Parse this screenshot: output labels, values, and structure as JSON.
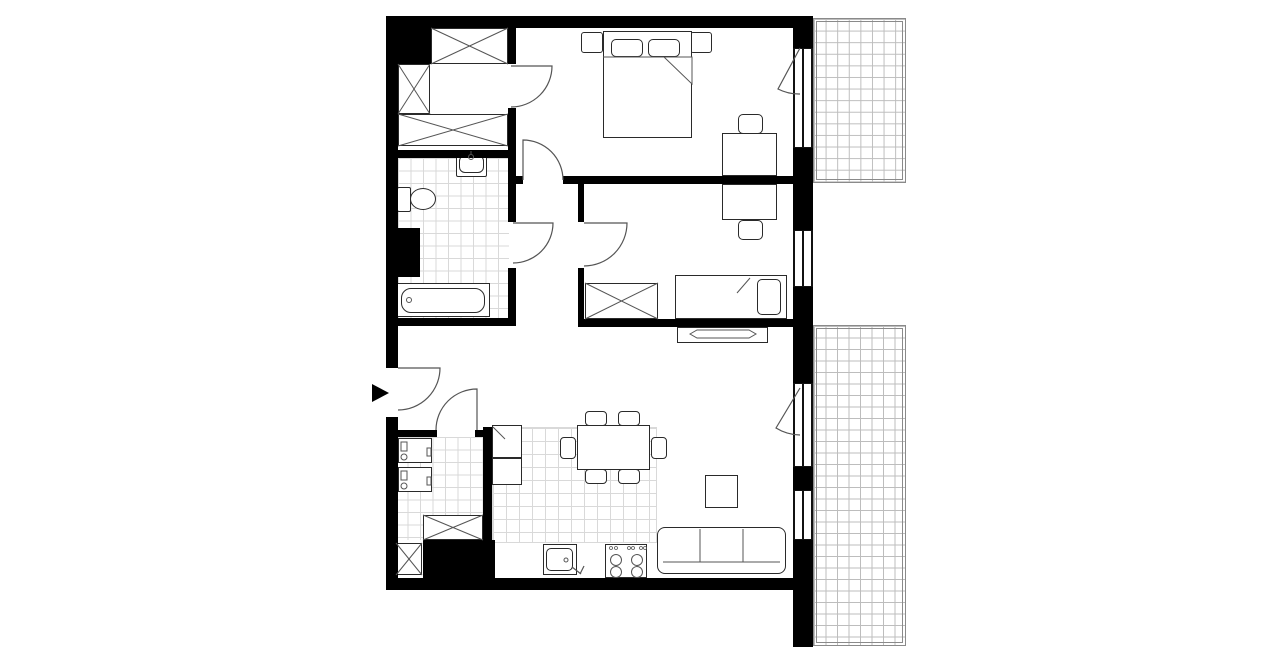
{
  "canvas": {
    "w": 1280,
    "h": 667,
    "bg": "#ffffff"
  },
  "colors": {
    "wall": "#000000",
    "line": "#2a2a2a",
    "thin": "#555555",
    "tile": "#d9d9d9",
    "balconyLine": "#bdbdbd",
    "frame": "#8a8a8a"
  },
  "tiles": [
    {
      "name": "bathroom-floor-tiles",
      "x": 398,
      "y": 158,
      "w": 111,
      "h": 160,
      "cell": 12.5
    },
    {
      "name": "utility-floor-tiles",
      "x": 395,
      "y": 437,
      "w": 88,
      "h": 103,
      "cell": 12.5
    },
    {
      "name": "kitchen-floor-tiles",
      "x": 492,
      "y": 427,
      "w": 165,
      "h": 116,
      "cell": 13,
      "edge": true
    },
    {
      "name": "balcony-top-floor",
      "x": 813,
      "y": 18,
      "w": 93,
      "h": 165,
      "cell": 11.6,
      "frame": true
    },
    {
      "name": "terrace-bottom-floor",
      "x": 813,
      "y": 325,
      "w": 93,
      "h": 321,
      "cell": 11.5,
      "frame": true
    }
  ],
  "furniture": [
    {
      "name": "bedroom1-nightstand-left",
      "x": 581,
      "y": 32,
      "w": 22,
      "h": 21,
      "r": 3
    },
    {
      "name": "bedroom1-nightstand-right",
      "x": 690,
      "y": 32,
      "w": 22,
      "h": 21,
      "r": 3
    },
    {
      "name": "bedroom1-double-bed",
      "x": 603,
      "y": 31,
      "w": 89,
      "h": 107
    },
    {
      "name": "bedroom1-pillow-left",
      "x": 611,
      "y": 39,
      "w": 32,
      "h": 18,
      "r": 5
    },
    {
      "name": "bedroom1-pillow-right",
      "x": 648,
      "y": 39,
      "w": 32,
      "h": 18,
      "r": 5
    },
    {
      "name": "bedroom1-desk",
      "x": 722,
      "y": 133,
      "w": 55,
      "h": 43
    },
    {
      "name": "bedroom1-desk-chair",
      "x": 738,
      "y": 114,
      "w": 25,
      "h": 20,
      "r": 5
    },
    {
      "name": "dressing-wardrobe-top",
      "x": 431,
      "y": 28,
      "w": 77,
      "h": 36
    },
    {
      "name": "dressing-wardrobe-left",
      "x": 398,
      "y": 64,
      "w": 32,
      "h": 50
    },
    {
      "name": "dressing-wardrobe-bottom",
      "x": 398,
      "y": 114,
      "w": 110,
      "h": 32
    },
    {
      "name": "bedroom2-desk",
      "x": 722,
      "y": 184,
      "w": 55,
      "h": 36
    },
    {
      "name": "bedroom2-desk-chair",
      "x": 738,
      "y": 220,
      "w": 25,
      "h": 20,
      "r": 5
    },
    {
      "name": "bedroom2-wardrobe",
      "x": 585,
      "y": 283,
      "w": 73,
      "h": 36
    },
    {
      "name": "bedroom2-single-bed",
      "x": 675,
      "y": 275,
      "w": 112,
      "h": 44
    },
    {
      "name": "bedroom2-pillow",
      "x": 757,
      "y": 279,
      "w": 24,
      "h": 36,
      "r": 5
    },
    {
      "name": "tv-sideboard",
      "x": 677,
      "y": 327,
      "w": 91,
      "h": 16
    },
    {
      "name": "coffee-table",
      "x": 705,
      "y": 475,
      "w": 33,
      "h": 33
    },
    {
      "name": "sofa",
      "x": 657,
      "y": 527,
      "w": 129,
      "h": 47,
      "r": 8
    },
    {
      "name": "fridge-unit",
      "x": 492,
      "y": 425,
      "w": 30,
      "h": 33
    },
    {
      "name": "kitchen-unit",
      "x": 492,
      "y": 458,
      "w": 30,
      "h": 27
    },
    {
      "name": "dining-table",
      "x": 577,
      "y": 425,
      "w": 73,
      "h": 45
    },
    {
      "name": "dining-chair-north-1",
      "x": 585,
      "y": 411,
      "w": 22,
      "h": 15,
      "r": 4
    },
    {
      "name": "dining-chair-north-2",
      "x": 618,
      "y": 411,
      "w": 22,
      "h": 15,
      "r": 4
    },
    {
      "name": "dining-chair-south-1",
      "x": 585,
      "y": 469,
      "w": 22,
      "h": 15,
      "r": 4
    },
    {
      "name": "dining-chair-south-2",
      "x": 618,
      "y": 469,
      "w": 22,
      "h": 15,
      "r": 4
    },
    {
      "name": "dining-chair-west",
      "x": 560,
      "y": 437,
      "w": 16,
      "h": 22,
      "r": 4
    },
    {
      "name": "dining-chair-east",
      "x": 651,
      "y": 437,
      "w": 16,
      "h": 22,
      "r": 4
    },
    {
      "name": "kitchen-sink-unit",
      "x": 543,
      "y": 544,
      "w": 34,
      "h": 31
    },
    {
      "name": "kitchen-sink-basin",
      "x": 546,
      "y": 548,
      "w": 27,
      "h": 23,
      "r": 5,
      "bw": 1
    },
    {
      "name": "stove",
      "x": 605,
      "y": 544,
      "w": 42,
      "h": 34
    },
    {
      "name": "washing-machine-1",
      "x": 398,
      "y": 438,
      "w": 34,
      "h": 25
    },
    {
      "name": "washing-machine-2",
      "x": 398,
      "y": 467,
      "w": 34,
      "h": 25
    },
    {
      "name": "utility-wardrobe-1",
      "x": 423,
      "y": 515,
      "w": 60,
      "h": 25
    },
    {
      "name": "utility-wardrobe-2",
      "x": 396,
      "y": 543,
      "w": 26,
      "h": 32
    },
    {
      "name": "bathroom-sink",
      "x": 456,
      "y": 151,
      "w": 31,
      "h": 26,
      "r": 2
    },
    {
      "name": "bathroom-sink-basin",
      "x": 459,
      "y": 155,
      "w": 25,
      "h": 18,
      "r": 6,
      "bw": 1
    },
    {
      "name": "toilet-tank",
      "x": 397,
      "y": 187,
      "w": 14,
      "h": 25,
      "r": 2
    },
    {
      "name": "toilet-bowl",
      "x": 410,
      "y": 188,
      "w": 26,
      "h": 22,
      "r": "50%"
    },
    {
      "name": "bathtub",
      "x": 396,
      "y": 283,
      "w": 94,
      "h": 34
    },
    {
      "name": "bathtub-inner",
      "x": 401,
      "y": 288,
      "w": 84,
      "h": 25,
      "r": 10,
      "bw": 1
    }
  ],
  "walls": [
    {
      "name": "wall-top",
      "x": 386,
      "y": 16,
      "w": 407,
      "h": 12
    },
    {
      "name": "wall-left-upper",
      "x": 386,
      "y": 16,
      "w": 12,
      "h": 352
    },
    {
      "name": "wall-left-lower",
      "x": 386,
      "y": 417,
      "w": 12,
      "h": 173
    },
    {
      "name": "wall-bottom",
      "x": 386,
      "y": 578,
      "w": 407,
      "h": 12
    },
    {
      "name": "corner-block",
      "x": 398,
      "y": 16,
      "w": 33,
      "h": 48
    },
    {
      "name": "dressing-east-wall-upper",
      "x": 508,
      "y": 28,
      "w": 8,
      "h": 36
    },
    {
      "name": "dressing-east-wall-lower",
      "x": 508,
      "y": 108,
      "w": 8,
      "h": 50
    },
    {
      "name": "bathroom-north-wall",
      "x": 386,
      "y": 150,
      "w": 130,
      "h": 8
    },
    {
      "name": "bathroom-east-wall-upper",
      "x": 508,
      "y": 158,
      "w": 8,
      "h": 64
    },
    {
      "name": "bathroom-east-wall-lower",
      "x": 508,
      "y": 268,
      "w": 8,
      "h": 58
    },
    {
      "name": "bathroom-south-wall",
      "x": 386,
      "y": 318,
      "w": 130,
      "h": 8
    },
    {
      "name": "bathroom-shaft",
      "x": 386,
      "y": 228,
      "w": 34,
      "h": 49
    },
    {
      "name": "bedroom1-south-wall-nub",
      "x": 516,
      "y": 176,
      "w": 7,
      "h": 8
    },
    {
      "name": "bedroom1-south-wall",
      "x": 563,
      "y": 176,
      "w": 230,
      "h": 8
    },
    {
      "name": "bedroom2-west-wall-upper",
      "x": 578,
      "y": 184,
      "w": 6,
      "h": 38
    },
    {
      "name": "bedroom2-west-wall-lower",
      "x": 578,
      "y": 268,
      "w": 6,
      "h": 59
    },
    {
      "name": "bedroom2-south-wall",
      "x": 578,
      "y": 319,
      "w": 215,
      "h": 8
    },
    {
      "name": "east-wall-top",
      "x": 793,
      "y": 16,
      "w": 20,
      "h": 32
    },
    {
      "name": "east-wall-mid-1",
      "x": 793,
      "y": 148,
      "w": 20,
      "h": 82
    },
    {
      "name": "east-wall-mid-2",
      "x": 793,
      "y": 287,
      "w": 20,
      "h": 96
    },
    {
      "name": "east-wall-mid-3",
      "x": 793,
      "y": 467,
      "w": 20,
      "h": 23
    },
    {
      "name": "east-wall-bottom",
      "x": 793,
      "y": 540,
      "w": 20,
      "h": 107
    },
    {
      "name": "utility-north-wall",
      "x": 395,
      "y": 430,
      "w": 42,
      "h": 7
    },
    {
      "name": "utility-north-stub",
      "x": 475,
      "y": 430,
      "w": 10,
      "h": 7
    },
    {
      "name": "kitchen-west-wall",
      "x": 483,
      "y": 427,
      "w": 9,
      "h": 160
    },
    {
      "name": "utility-shaft",
      "x": 423,
      "y": 540,
      "w": 72,
      "h": 38
    }
  ],
  "windows": [
    {
      "name": "bedroom1-balcony-window",
      "x": 793,
      "y": 48,
      "w": 20,
      "h": 100
    },
    {
      "name": "bedroom2-window",
      "x": 793,
      "y": 230,
      "w": 20,
      "h": 57
    },
    {
      "name": "livingroom-terrace-window-1",
      "x": 793,
      "y": 383,
      "w": 20,
      "h": 84
    },
    {
      "name": "livingroom-terrace-window-2",
      "x": 793,
      "y": 490,
      "w": 20,
      "h": 50
    }
  ],
  "svg": [
    {
      "name": "entry-door-swing",
      "kind": "path",
      "d": "M398,368 L440,368 A42,42 0 0 1 398,410"
    },
    {
      "name": "utility-door-swing",
      "kind": "path",
      "d": "M477,430 L477,389 A41,41 0 0 0 436,430"
    },
    {
      "name": "dressing-door-swing",
      "kind": "path",
      "d": "M511,66 L552,66 A41,41 0 0 1 511,107"
    },
    {
      "name": "bathroom-door-swing",
      "kind": "path",
      "d": "M513,223 L553,223 A40,40 0 0 1 513,263"
    },
    {
      "name": "bedroom1-door-swing",
      "kind": "path",
      "d": "M523,180 L523,140 A40,40 0 0 1 563,180"
    },
    {
      "name": "bedroom2-door-swing",
      "kind": "path",
      "d": "M584,223 L627,223 A43,43 0 0 1 584,266"
    },
    {
      "name": "bedroom1-balcony-door-swing",
      "kind": "path",
      "d": "M800,48 L778,89 A46,46 0 0 0 800,94"
    },
    {
      "name": "livingroom-balcony-door-swing",
      "kind": "path",
      "d": "M800,388 L776,428 A47,47 0 0 0 800,435"
    },
    {
      "name": "dressing-wardrobe-top-cross-1",
      "kind": "line",
      "x1": 431,
      "y1": 28,
      "x2": 508,
      "y2": 64,
      "sw": 1
    },
    {
      "name": "dressing-wardrobe-top-cross-2",
      "kind": "line",
      "x1": 508,
      "y1": 28,
      "x2": 431,
      "y2": 64,
      "sw": 1
    },
    {
      "name": "dressing-wardrobe-left-cross-1",
      "kind": "line",
      "x1": 398,
      "y1": 64,
      "x2": 430,
      "y2": 114,
      "sw": 1
    },
    {
      "name": "dressing-wardrobe-left-cross-2",
      "kind": "line",
      "x1": 430,
      "y1": 64,
      "x2": 398,
      "y2": 114,
      "sw": 1
    },
    {
      "name": "dressing-wardrobe-bottom-cross-1",
      "kind": "line",
      "x1": 398,
      "y1": 114,
      "x2": 508,
      "y2": 146,
      "sw": 1
    },
    {
      "name": "dressing-wardrobe-bottom-cross-2",
      "kind": "line",
      "x1": 508,
      "y1": 114,
      "x2": 398,
      "y2": 146,
      "sw": 1
    },
    {
      "name": "bedroom2-wardrobe-cross-1",
      "kind": "line",
      "x1": 585,
      "y1": 283,
      "x2": 658,
      "y2": 319,
      "sw": 1
    },
    {
      "name": "bedroom2-wardrobe-cross-2",
      "kind": "line",
      "x1": 658,
      "y1": 283,
      "x2": 585,
      "y2": 319,
      "sw": 1
    },
    {
      "name": "utility-wardrobe-1-cross-1",
      "kind": "line",
      "x1": 423,
      "y1": 515,
      "x2": 483,
      "y2": 540,
      "sw": 1
    },
    {
      "name": "utility-wardrobe-1-cross-2",
      "kind": "line",
      "x1": 483,
      "y1": 515,
      "x2": 423,
      "y2": 540,
      "sw": 1
    },
    {
      "name": "utility-wardrobe-2-cross-1",
      "kind": "line",
      "x1": 396,
      "y1": 543,
      "x2": 422,
      "y2": 575,
      "sw": 1
    },
    {
      "name": "utility-wardrobe-2-cross-2",
      "kind": "line",
      "x1": 422,
      "y1": 543,
      "x2": 396,
      "y2": 575,
      "sw": 1
    },
    {
      "name": "duvet-edge-line",
      "kind": "line",
      "x1": 603,
      "y1": 57,
      "x2": 692,
      "y2": 57,
      "sw": 1
    },
    {
      "name": "duvet-fold",
      "kind": "path",
      "d": "M664,57 L692,57 L692,84 Z",
      "fill": "#ffffff",
      "sw": 1
    },
    {
      "name": "bedroom2-blanket-fold",
      "kind": "line",
      "x1": 750,
      "y1": 278,
      "x2": 737,
      "y2": 293,
      "sw": 1
    },
    {
      "name": "tv-on-sideboard",
      "kind": "path",
      "d": "M690,334 L697,330 L749,330 L756,334 L749,338 L697,338 Z",
      "fill": "#ffffff",
      "sw": 1
    },
    {
      "name": "sofa-cushion-divider-1",
      "kind": "line",
      "x1": 700,
      "y1": 529,
      "x2": 700,
      "y2": 562,
      "sw": 1
    },
    {
      "name": "sofa-cushion-divider-2",
      "kind": "line",
      "x1": 743,
      "y1": 529,
      "x2": 743,
      "y2": 562,
      "sw": 1
    },
    {
      "name": "sofa-back-line",
      "kind": "line",
      "x1": 663,
      "y1": 562,
      "x2": 780,
      "y2": 562,
      "sw": 1
    },
    {
      "name": "fridge-door-diagonal",
      "kind": "line",
      "x1": 493,
      "y1": 427,
      "x2": 505,
      "y2": 439,
      "sw": 1
    },
    {
      "name": "kitchen-sink-drain",
      "kind": "circle",
      "cx": 566,
      "cy": 560,
      "r": 2,
      "sw": 1
    },
    {
      "name": "kitchen-sink-faucet",
      "kind": "path",
      "d": "M572,567 l9,7 M580,574 l4,-8",
      "sw": 1.2
    },
    {
      "name": "stove-knob-1",
      "kind": "circle",
      "cx": 611,
      "cy": 548,
      "r": 1.5,
      "sw": 0.8
    },
    {
      "name": "stove-knob-2",
      "kind": "circle",
      "cx": 616,
      "cy": 548,
      "r": 1.5,
      "sw": 0.8
    },
    {
      "name": "stove-knob-3",
      "kind": "circle",
      "cx": 629,
      "cy": 548,
      "r": 1.5,
      "sw": 0.8
    },
    {
      "name": "stove-knob-4",
      "kind": "circle",
      "cx": 633,
      "cy": 548,
      "r": 1.5,
      "sw": 0.8
    },
    {
      "name": "stove-knob-5",
      "kind": "circle",
      "cx": 641,
      "cy": 548,
      "r": 1.5,
      "sw": 0.8
    },
    {
      "name": "stove-knob-6",
      "kind": "circle",
      "cx": 645,
      "cy": 548,
      "r": 1.5,
      "sw": 0.8
    },
    {
      "name": "stove-burner-1",
      "kind": "circle",
      "cx": 616,
      "cy": 560,
      "r": 5.5,
      "sw": 1
    },
    {
      "name": "stove-burner-2",
      "kind": "circle",
      "cx": 637,
      "cy": 560,
      "r": 5.5,
      "sw": 1
    },
    {
      "name": "stove-burner-3",
      "kind": "circle",
      "cx": 616,
      "cy": 572,
      "r": 5.5,
      "sw": 1
    },
    {
      "name": "stove-burner-4",
      "kind": "circle",
      "cx": 637,
      "cy": 572,
      "r": 5.5,
      "sw": 1
    },
    {
      "name": "bathroom-sink-faucet",
      "kind": "circle",
      "cx": 471,
      "cy": 157,
      "r": 2.5,
      "sw": 1
    },
    {
      "name": "bathroom-sink-faucet-stem",
      "kind": "line",
      "x1": 471,
      "y1": 151,
      "x2": 471,
      "y2": 154,
      "sw": 1
    },
    {
      "name": "bathtub-drain",
      "kind": "circle",
      "cx": 409,
      "cy": 300,
      "r": 2.5,
      "sw": 1
    },
    {
      "name": "washer-1-panel",
      "kind": "rect",
      "x": 401,
      "y": 442,
      "w": 6,
      "h": 9,
      "sw": 1
    },
    {
      "name": "washer-1-dial",
      "kind": "circle",
      "cx": 404,
      "cy": 457,
      "r": 3,
      "sw": 1
    },
    {
      "name": "washer-1-latch",
      "kind": "rect",
      "x": 427,
      "y": 448,
      "w": 4,
      "h": 8,
      "sw": 1
    },
    {
      "name": "washer-2-panel",
      "kind": "rect",
      "x": 401,
      "y": 471,
      "w": 6,
      "h": 9,
      "sw": 1
    },
    {
      "name": "washer-2-dial",
      "kind": "circle",
      "cx": 404,
      "cy": 486,
      "r": 3,
      "sw": 1
    },
    {
      "name": "washer-2-latch",
      "kind": "rect",
      "x": 427,
      "y": 477,
      "w": 4,
      "h": 8,
      "sw": 1
    },
    {
      "name": "entrance-arrow",
      "kind": "polygon",
      "points": "372,384 389,393 372,402",
      "fill": "#000000",
      "sw": 0
    }
  ]
}
